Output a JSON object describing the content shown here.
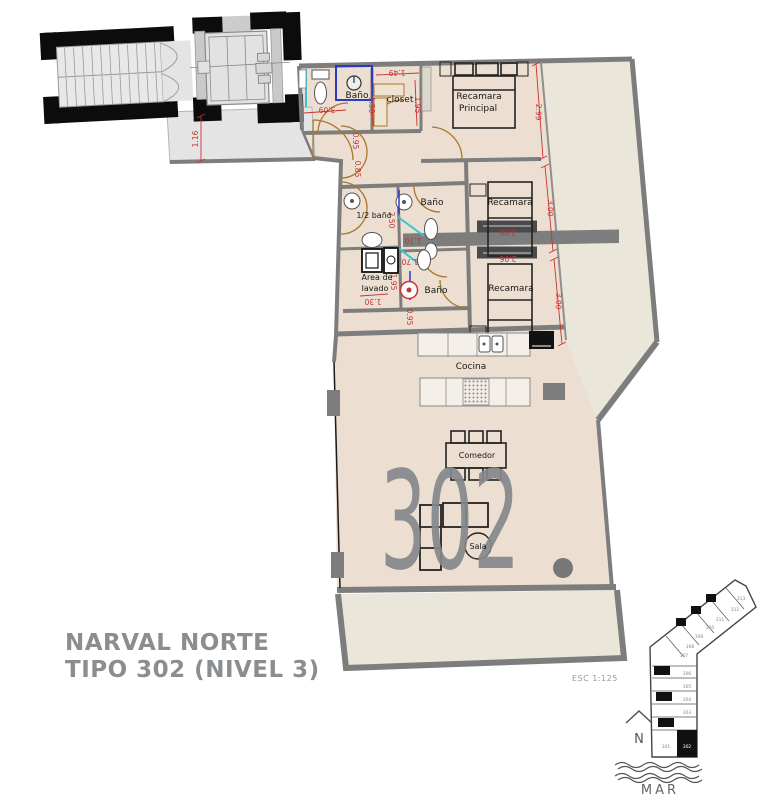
{
  "title": {
    "line1": "NARVAL NORTE",
    "line2": "TIPO 302 (NIVEL 3)"
  },
  "scale_note": "ESC 1:125",
  "watermark_unit": "302",
  "rooms": {
    "bano_top": "Baño",
    "closet": "closet",
    "recamara_principal_l1": "Recamara",
    "recamara_principal_l2": "Principal",
    "medio_bano": "1/2 baño",
    "bano_mid": "Baño",
    "recamara_1": "Recamara",
    "area_lavado_l1": "Area de",
    "area_lavado_l2": "lavado",
    "bano_low": "Baño",
    "recamara_2": "Recamara",
    "cocina": "Cocina",
    "comedor": "Comedor",
    "sala": "Sala"
  },
  "dims": {
    "landing": "1.16",
    "foyer_w": "3.09",
    "closet_w": "1.49",
    "bano_top_h": "1.50",
    "closet_h": "1.95",
    "hall_a": "0.95",
    "hall_b": "0.85",
    "recamara_principal_h": "2.99",
    "medio_bano_h": "2.50",
    "bano_mid_w": "1.70",
    "bano_low_w": "1.70",
    "lavado_h": "1.95",
    "lavado_w": "1.30",
    "bano_low_h": "0.95",
    "closet_bar_1": "2.06",
    "closet_bar_2": "2.06",
    "recamara_1_h": "3.00",
    "recamara_2_h": "3.00"
  },
  "key_plan": {
    "units": [
      "301",
      "302",
      "303",
      "304",
      "305",
      "306",
      "307",
      "308",
      "309",
      "310",
      "311",
      "312",
      "313"
    ],
    "highlighted_unit": "302",
    "north_label": "N",
    "sea_label": "MAR"
  },
  "colors": {
    "interior": "#ecdfd1",
    "terrace": "#eae6d9",
    "landing": "#e4e4e4",
    "wall": "#7d7d7d",
    "dimension": "#c83232",
    "door": "#a8762e",
    "glass": "#35c4d7",
    "shower_frame": "#2b3bbf",
    "watermark": "#85888c"
  }
}
